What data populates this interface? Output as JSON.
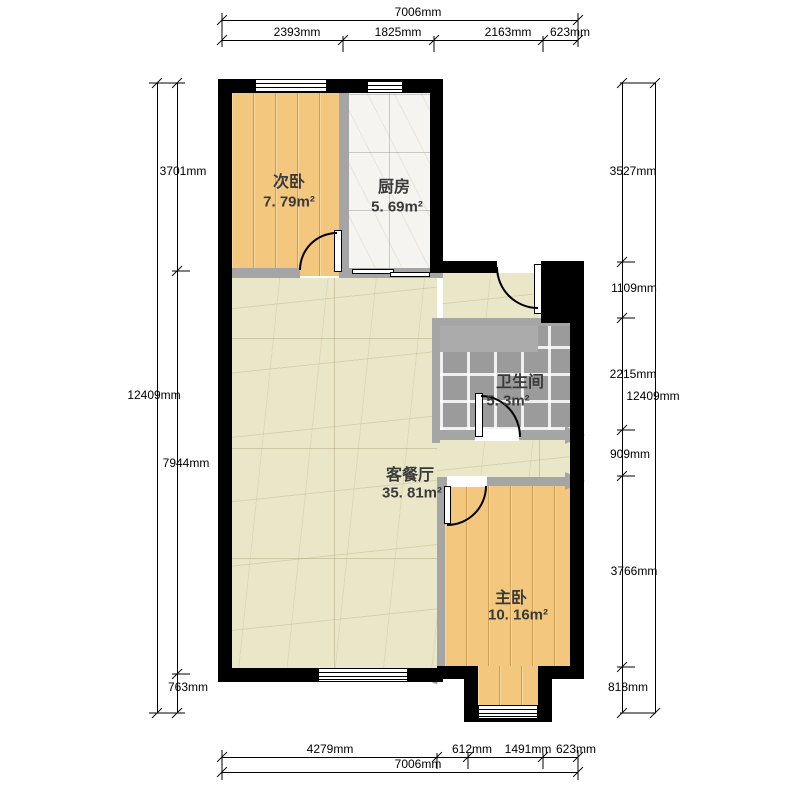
{
  "rooms": {
    "bedroom2": {
      "name": "次卧",
      "area": "7. 79m²"
    },
    "kitchen": {
      "name": "厨房",
      "area": "5. 69m²"
    },
    "bathroom": {
      "name": "卫生间",
      "area": "5. 3m²"
    },
    "living": {
      "name": "客餐厅",
      "area": "35. 81m²"
    },
    "master": {
      "name": "主卧",
      "area": "10. 16m²"
    }
  },
  "dimensions": {
    "top": {
      "total": "7006mm",
      "segments": [
        "2393mm",
        "1825mm",
        "2163mm",
        "623mm"
      ]
    },
    "bottom": {
      "total": "7006mm",
      "segments": [
        "4279mm",
        "612mm",
        "1491mm",
        "623mm"
      ]
    },
    "left": {
      "total": "12409mm",
      "segments": [
        "3701mm",
        "7944mm",
        "763mm"
      ]
    },
    "right": {
      "total": "12409mm",
      "segments": [
        "3527mm",
        "1109mm",
        "2215mm",
        "909mm",
        "3766mm",
        "818mm"
      ]
    }
  },
  "colors": {
    "wall_exterior": "#000000",
    "wall_interior": "#a5a5a5",
    "floor_wood": "#f3c87e",
    "floor_living": "#eae7c9",
    "floor_kitchen": "#f5f4f1",
    "floor_bath": "#9b9b9b",
    "text": "#3a3a3a"
  }
}
